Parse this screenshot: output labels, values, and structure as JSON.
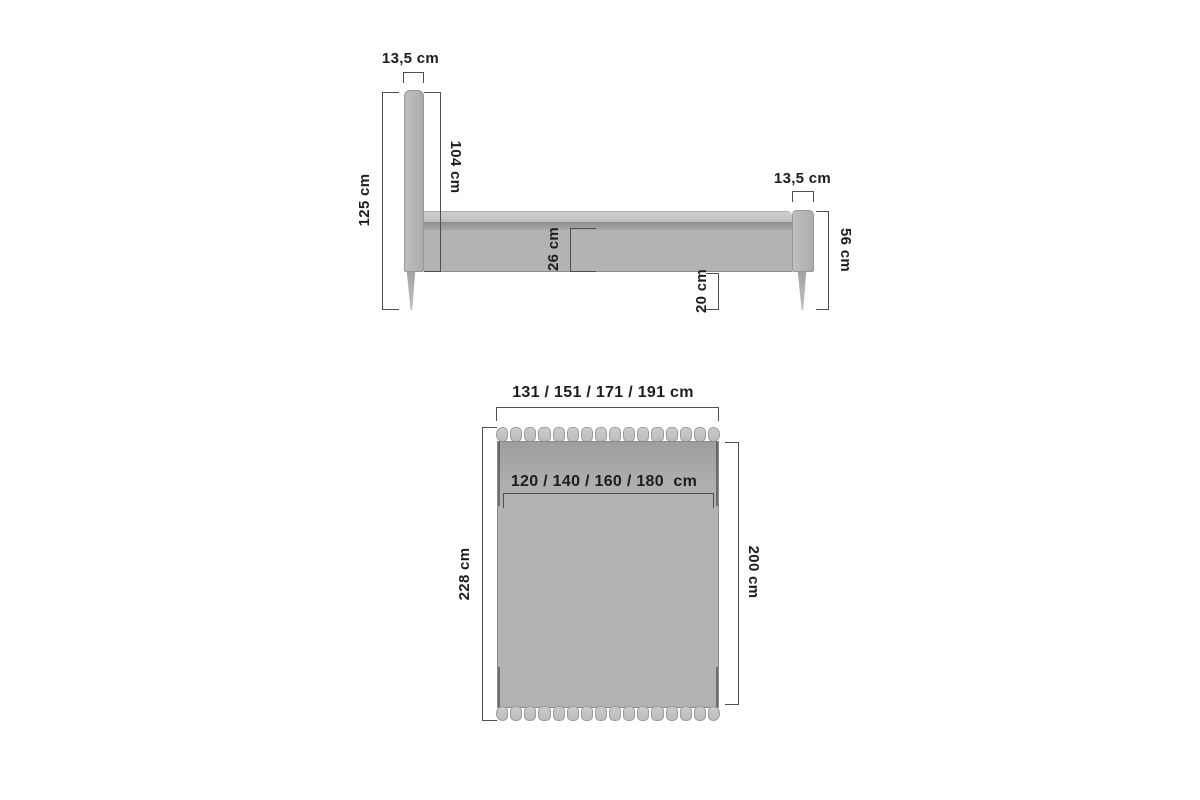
{
  "diagram_title": "bed-dimensions-diagram",
  "colors": {
    "background": "#ffffff",
    "dimension_line": "#4e4e4e",
    "dimension_text": "#1d1d1d",
    "bed_fill_light": "#c7c7c7",
    "bed_fill_mid": "#b3b3b3",
    "bed_fill_shadow": "#8e8e8e"
  },
  "side_view": {
    "dims": {
      "headboard_thickness": "13,5 cm",
      "total_height": "125 cm",
      "headboard_height": "104 cm",
      "frame_side_height": "26 cm",
      "under_bed_clearance": "20 cm",
      "footboard_thickness": "13,5 cm",
      "footboard_height": "56 cm"
    }
  },
  "top_view": {
    "dims": {
      "overall_width_options": "131 / 151 / 171 / 191 cm",
      "mattress_width_options": "120 / 140 / 160 / 180  cm",
      "overall_length": "228 cm",
      "mattress_length": "200 cm"
    },
    "headboard_slat_count": 16,
    "footboard_slat_count": 16
  }
}
